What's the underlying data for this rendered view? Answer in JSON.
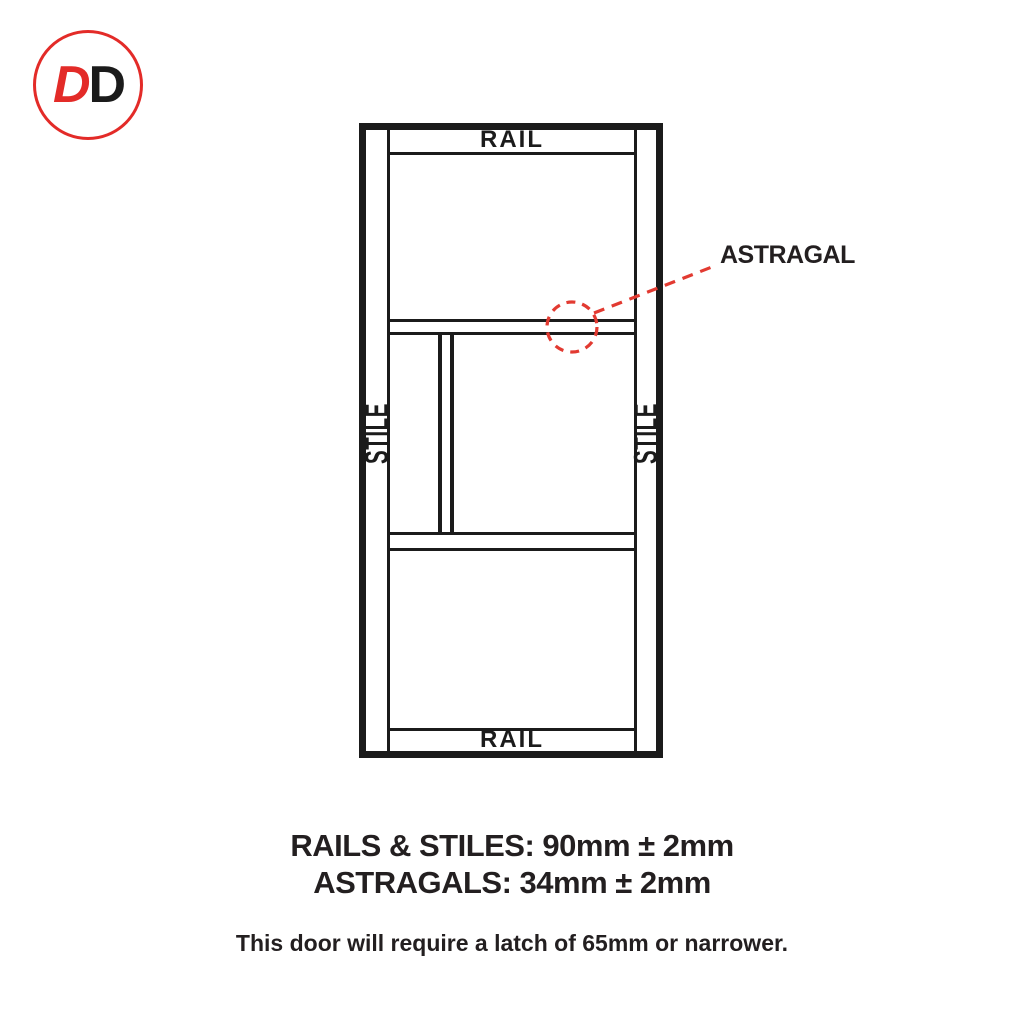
{
  "logo": {
    "letter_1": "D",
    "letter_2": "D"
  },
  "diagram": {
    "top_rail_label": "RAIL",
    "bottom_rail_label": "RAIL",
    "left_stile_label": "STILE",
    "right_stile_label": "STILE",
    "astragal_label": "ASTRAGAL"
  },
  "specs": {
    "rails_stiles": "RAILS & STILES: 90mm ± 2mm",
    "astragals": "ASTRAGALS: 34mm ± 2mm",
    "latch_note": "This door will require a latch of 65mm or narrower."
  },
  "colors": {
    "accent_red": "#e32b28",
    "line_black": "#1b1b1b",
    "text_black": "#231f20"
  }
}
